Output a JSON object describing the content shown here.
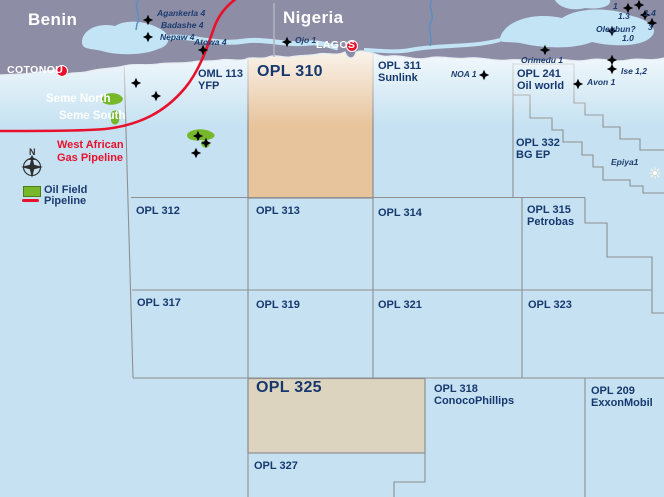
{
  "map_title": "West African offshore licence blocks map (Benin / Nigeria)",
  "countries": {
    "benin": "Benin",
    "nigeria": "Nigeria"
  },
  "cities": {
    "cotonou": "COTONOU",
    "lagos": "LAGOS"
  },
  "fields": {
    "seme_north": "Seme North",
    "seme_south": "Seme South"
  },
  "pipeline": {
    "line1": "West African",
    "line2": "Gas Pipeline"
  },
  "legend": {
    "north": "N",
    "oil_field": "Oil Field",
    "pipeline": "Pipeline"
  },
  "blocks": {
    "oml113": {
      "name": "OML 113",
      "operator": "YFP"
    },
    "opl310": {
      "name": "OPL 310"
    },
    "opl311": {
      "name": "OPL 311",
      "operator": "Sunlink"
    },
    "opl241": {
      "name": "OPL 241",
      "operator": "Oil world"
    },
    "opl332": {
      "name": "OPL 332",
      "operator": "BG EP"
    },
    "opl312": {
      "name": "OPL 312"
    },
    "opl313": {
      "name": "OPL 313"
    },
    "opl314": {
      "name": "OPL 314"
    },
    "opl315": {
      "name": "OPL 315",
      "operator": "Petrobas"
    },
    "opl317": {
      "name": "OPL 317"
    },
    "opl319": {
      "name": "OPL 319"
    },
    "opl321": {
      "name": "OPL 321"
    },
    "opl323": {
      "name": "OPL 323"
    },
    "opl325": {
      "name": "OPL 325"
    },
    "opl318": {
      "name": "OPL 318",
      "operator": "ConocoPhillips"
    },
    "opl209": {
      "name": "OPL 209",
      "operator": "ExxonMobil"
    },
    "opl327": {
      "name": "OPL 327"
    }
  },
  "wells": {
    "agankerla": "Agankerla 4",
    "badashe": "Badashe 4",
    "nepaw": "Nepaw 4",
    "atowa": "Atowa 4",
    "ojo": "Ojo 1",
    "noa": "NOA 1",
    "orimedu": "Orimedu 1",
    "ise": "Ise 1,2",
    "avon": "Avon 1",
    "epiya": "Epiya1",
    "olegbun": "Olegbun?",
    "olegbun_num": "1.0",
    "w1": "1",
    "w13": "1.3",
    "w14": "1.4",
    "w3": "3"
  },
  "colors": {
    "sea": "#c6e2f2",
    "land": "#8d8da5",
    "lagoon": "#c2e4f4",
    "block_highlight_310": "#e7c49c",
    "block_highlight_325": "#dcd4bf",
    "pipeline_red": "#e8112d",
    "oil_field_green": "#76b82a",
    "label_navy": "#16386f",
    "grid_gray": "#8f8f8f"
  }
}
